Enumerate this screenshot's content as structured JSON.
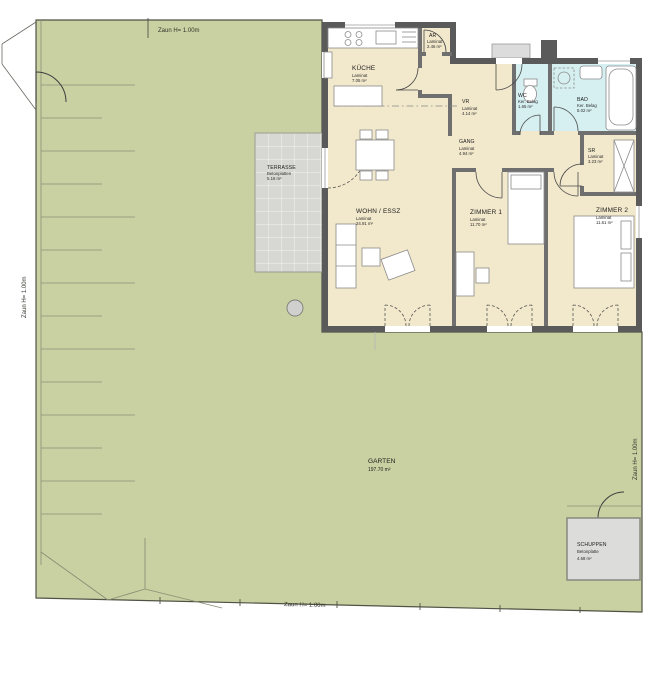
{
  "plan": {
    "fences": {
      "top": "Zaun H= 1.00m",
      "left": "Zaun H= 1.00m",
      "right": "Zaun H= 1.00m",
      "bottom": "Zaun H= 1.00m"
    },
    "rooms": {
      "kueche": {
        "name": "KÜCHE",
        "floor": "Laminat",
        "area": "7.05 m²"
      },
      "ar": {
        "name": "AR",
        "floor": "Laminat",
        "area": "2.46 m²"
      },
      "vr": {
        "name": "VR",
        "floor": "Laminat",
        "area": "4.14 m²"
      },
      "gang": {
        "name": "GANG",
        "floor": "Laminat",
        "area": "4.94 m²"
      },
      "wc": {
        "name": "WC",
        "floor": "Ker. Belag",
        "area": "1.65 m²"
      },
      "bad": {
        "name": "BAD",
        "floor": "Ker. Belag",
        "area": "5.02 m²"
      },
      "sr": {
        "name": "SR",
        "floor": "Laminat",
        "area": "3.23 m²"
      },
      "zimmer1": {
        "name": "ZIMMER 1",
        "floor": "Laminat",
        "area": "11.70 m²"
      },
      "zimmer2": {
        "name": "ZIMMER 2",
        "floor": "Laminat",
        "area": "11.61 m²"
      },
      "wohn": {
        "name": "WOHN / ESSZ",
        "floor": "Laminat",
        "area": "24.91 m²"
      }
    },
    "outdoor": {
      "terrasse": {
        "name": "TERRASSE",
        "floor": "Betonplatten",
        "area": "5.16 m²"
      },
      "garten": {
        "name": "GARTEN",
        "area": "197.70 m²"
      },
      "schuppen": {
        "name": "SCHUPPEN",
        "floor": "Betonplatte",
        "area": "4.68 m²"
      }
    },
    "colors": {
      "garden": "#c9d1a2",
      "floor": "#f2e8cb",
      "wet_floor": "#d6f0f2",
      "wall": "#5a5a5a",
      "terrace": "#d7d7d4",
      "schuppen": "#dcdcda"
    }
  }
}
